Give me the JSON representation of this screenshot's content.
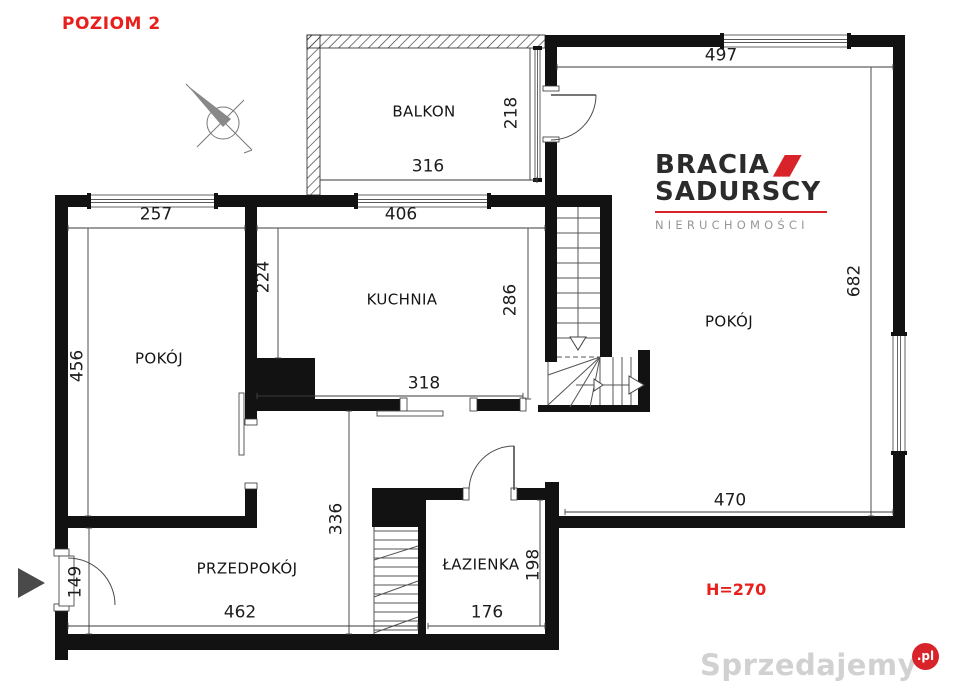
{
  "title": "POZIOM 2",
  "height_label": "H=270",
  "rooms": [
    {
      "label": "BALKON"
    },
    {
      "label": "KUCHNIA"
    },
    {
      "label": "POKÓJ"
    },
    {
      "label": "POKÓJ"
    },
    {
      "label": "PRZEDPOKÓJ"
    },
    {
      "label": "ŁAZIENKA"
    }
  ],
  "dims": [
    {
      "label": "497"
    },
    {
      "label": "218"
    },
    {
      "label": "316"
    },
    {
      "label": "257"
    },
    {
      "label": "406"
    },
    {
      "label": "682"
    },
    {
      "label": "224"
    },
    {
      "label": "286"
    },
    {
      "label": "456"
    },
    {
      "label": "318"
    },
    {
      "label": "470"
    },
    {
      "label": "336"
    },
    {
      "label": "462"
    },
    {
      "label": "176"
    },
    {
      "label": "198"
    },
    {
      "label": "149"
    }
  ],
  "logo": {
    "line1": "BRACIA",
    "line2": "SADURSCY",
    "tagline": "NIERUCHOMOŚCI"
  },
  "watermark": {
    "name": "Sprzedajemy",
    "tld": ".pl"
  },
  "icons": {
    "compass": "compass-rose-icon",
    "entrance_arrow": "entrance-arrow-icon"
  },
  "colors": {
    "accent_red": "#e8201d",
    "logo_red": "#d8232a",
    "wall_black": "#121212",
    "dim_text": "#1c1c1c"
  }
}
